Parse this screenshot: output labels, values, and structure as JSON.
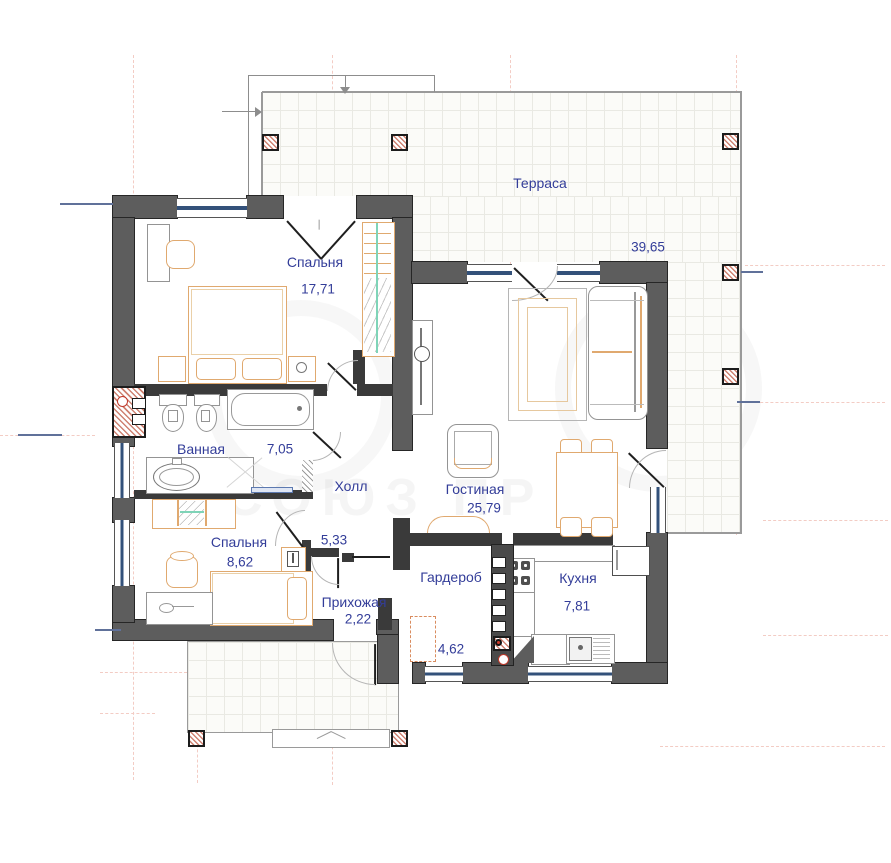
{
  "title": "План этажа",
  "watermark": "СОЮЗ ПР",
  "rooms": {
    "terrace": {
      "name": "Терраса",
      "area": "39,65"
    },
    "bedroom1": {
      "name": "Спальня",
      "area": "17,71"
    },
    "bathroom": {
      "name": "Ванная",
      "area": "7,05"
    },
    "hall": {
      "name": "Холл",
      "area": "5,33"
    },
    "living": {
      "name": "Гостиная",
      "area": "25,79"
    },
    "bedroom2": {
      "name": "Спальня",
      "area": "8,62"
    },
    "entry": {
      "name": "Прихожая",
      "area": "2,22"
    },
    "wardrobe": {
      "name": "Гардероб",
      "area": "4,62"
    },
    "kitchen": {
      "name": "Кухня",
      "area": "7,81"
    }
  },
  "colors": {
    "wall": "#5d5d5d",
    "inner_wall": "#3a3a3a",
    "label": "#333d99",
    "furniture": "#e0a96f",
    "window_glass": "#33517a",
    "column_hatch": "#cf8272",
    "tile_line": "#e9e9e3",
    "outline": "#9a9a9a",
    "rail_green": "#7fd4b8",
    "dimension": "#60719a",
    "axis": "#f3ccc4"
  }
}
